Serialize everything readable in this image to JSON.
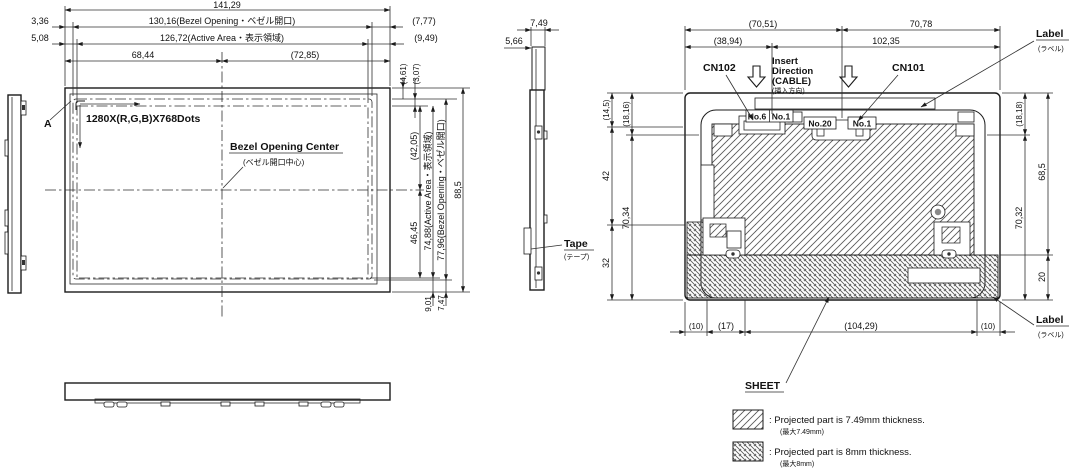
{
  "colors": {
    "line": "#1b1b1b",
    "bg": "#ffffff"
  },
  "front_view": {
    "dim_total_w": "141,29",
    "dim_bezel_w": "130,16(Bezel Opening・ベゼル開口)",
    "dim_active_w": "126,72(Active Area・表示領域)",
    "dim_center_left": "68,44",
    "dim_center_right": "(72,85)",
    "dim_bezel_off_l": "3,36",
    "dim_active_off_l": "5,08",
    "dim_bezel_off_r": "(7,77)",
    "dim_active_off_r": "(9,49)",
    "dim_bezel_off_t": "(4,61)",
    "dim_active_off_t": "(3,07)",
    "dim_center_upper": "(42,05)",
    "dim_center_lower": "46,45",
    "dim_active_h": "74,88(Active Area・表示領域)",
    "dim_bezel_h": "77,96(Bezel Opening・ベゼル開口)",
    "dim_total_h": "88,5",
    "dim_active_off_b": "9,01",
    "dim_bezel_off_b": "7,47",
    "section_mark": "A",
    "resolution": "1280X(R,G,B)X768Dots",
    "center_label": "Bezel Opening Center",
    "center_label_jp": "(ベゼル開口中心)"
  },
  "side_view": {
    "dim_thickness": "7,49",
    "dim_offset": "5,66",
    "tape_label": "Tape",
    "tape_label_jp": "(テープ)"
  },
  "back_view": {
    "dim_top_l": "(70,51)",
    "dim_top_r": "70,78",
    "dim_top_l2": "(38,94)",
    "dim_top_r2": "102,35",
    "dim_left_1": "(14,5)",
    "dim_left_2": "42",
    "dim_left_3": "32",
    "dim_left_in1": "(18,16)",
    "dim_left_in2": "70,34",
    "dim_right_in1": "(18,18)",
    "dim_right_in2": "70,32",
    "dim_right_1": "68,5",
    "dim_right_2": "20",
    "dim_bot_1": "(10)",
    "dim_bot_2": "(17)",
    "dim_bot_3": "(104,29)",
    "dim_bot_4": "(10)",
    "cn102": "CN102",
    "cn101": "CN101",
    "insert_l1": "Insert",
    "insert_l2": "Direction",
    "insert_l3": "(CABLE)",
    "insert_jp": "(挿入方向)",
    "no6": "No.6",
    "no1_a": "No.1",
    "no20": "No.20",
    "no1_b": "No.1",
    "label_top": "Label",
    "label_top_jp": "(ラベル)",
    "label_bot": "Label",
    "label_bot_jp": "(ラベル)",
    "sheet": "SHEET"
  },
  "legend": {
    "item1_text": ": Projected part is 7.49mm thickness.",
    "item1_jp": "(最大7.49mm)",
    "item2_text": ": Projected part is 8mm thickness.",
    "item2_jp": "(最大8mm)"
  }
}
